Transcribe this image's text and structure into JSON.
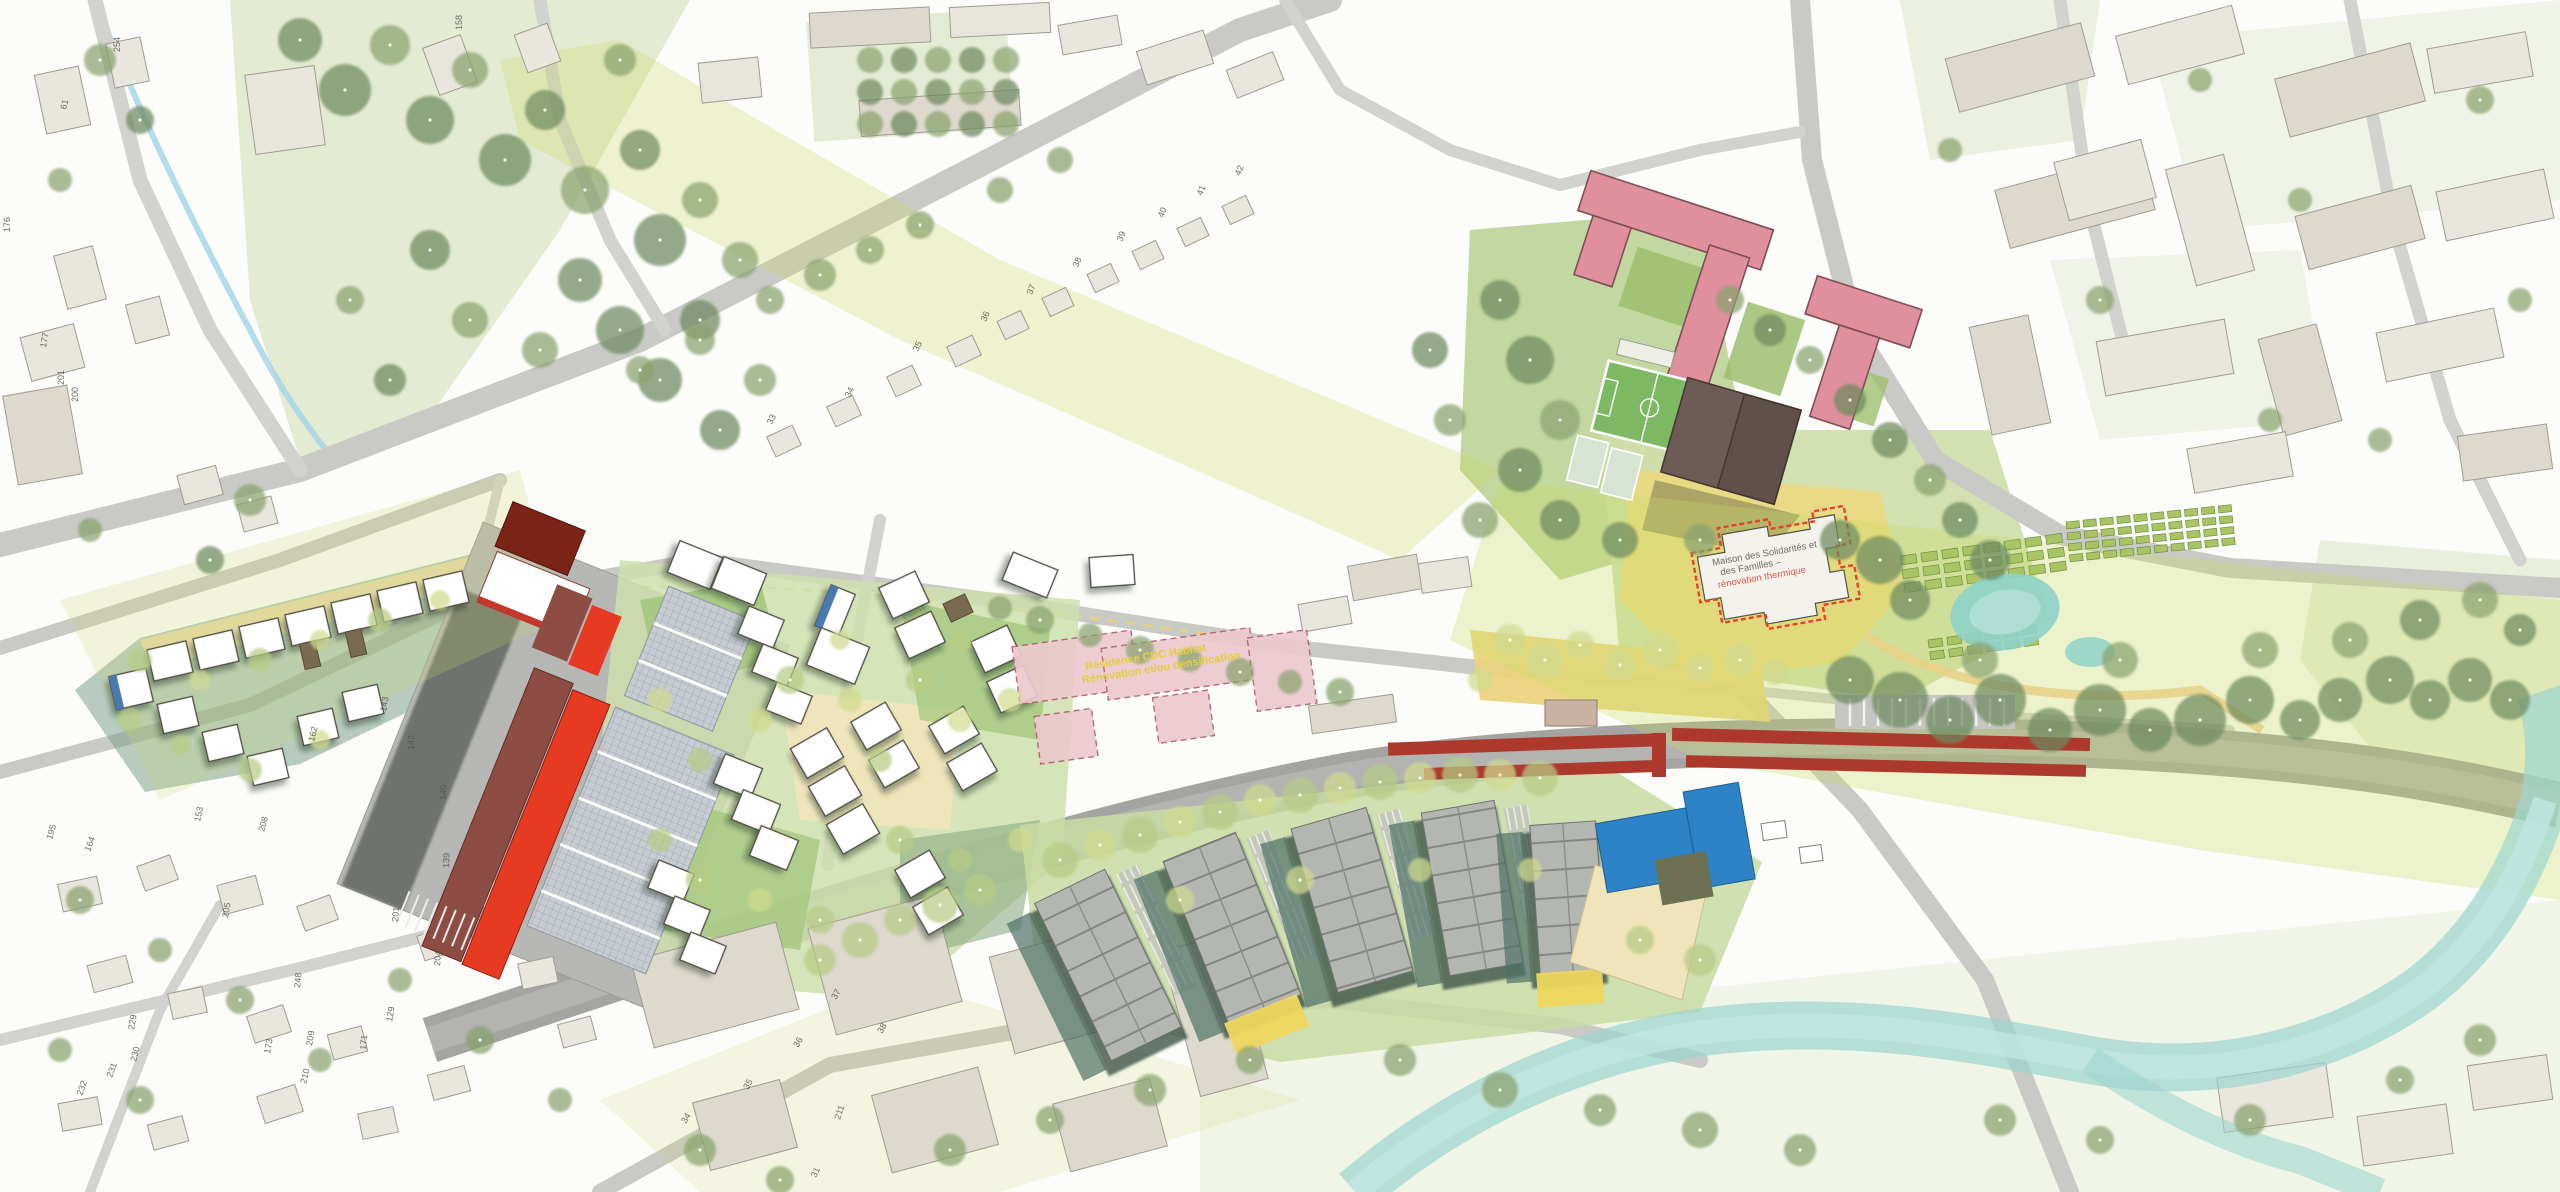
{
  "map": {
    "kind": "urban design masterplan site plan",
    "annotations": {
      "maison": {
        "line1": "Maison des Solidarités et",
        "line2": "des Familles –",
        "line3": "rénovation thermique"
      },
      "residence": {
        "line1": "Résidence CDC Habitat",
        "line2": "Rénovation et/ou densification"
      }
    },
    "colors": {
      "background": "#fcfcfa",
      "road": "#c9c9c6",
      "railway": "#a4a4a2",
      "platform_red": "#ac392c",
      "new_building_red": "#e63a22",
      "new_building_maroon": "#8e4d44",
      "dark_red_hall": "#7c2317",
      "school_pink": "#e08f9d",
      "residence_pink": "#ecc9ce",
      "sports_hall_brown": "#6e5b56",
      "blue_building": "#2d83c6",
      "water_teal": "#9ed6cf",
      "lawn_green": "#9fc478",
      "tree_dark": "#6d8a5e",
      "overlay_yellow_green": "#ccd95e",
      "plaza_yellow": "#ebd47d",
      "annotation_red": "#e4554a",
      "annotation_yellow": "#e3cf3d"
    },
    "parcels": [
      {
        "n": "254",
        "x": 120,
        "y": 52,
        "rot": -90
      },
      {
        "n": "61",
        "x": 66,
        "y": 110,
        "rot": -75
      },
      {
        "n": "176",
        "x": 10,
        "y": 232,
        "rot": -90
      },
      {
        "n": "177",
        "x": 46,
        "y": 348,
        "rot": -80
      },
      {
        "n": "200",
        "x": 78,
        "y": 402,
        "rot": -90
      },
      {
        "n": "201",
        "x": 64,
        "y": 385,
        "rot": -90
      },
      {
        "n": "158",
        "x": 462,
        "y": 30,
        "rot": -90
      },
      {
        "n": "33",
        "x": 772,
        "y": 425,
        "rot": -65
      },
      {
        "n": "34",
        "x": 850,
        "y": 398,
        "rot": -65
      },
      {
        "n": "35",
        "x": 918,
        "y": 352,
        "rot": -65
      },
      {
        "n": "36",
        "x": 986,
        "y": 322,
        "rot": -68
      },
      {
        "n": "37",
        "x": 1032,
        "y": 295,
        "rot": -68
      },
      {
        "n": "38",
        "x": 1078,
        "y": 268,
        "rot": -68
      },
      {
        "n": "39",
        "x": 1122,
        "y": 242,
        "rot": -68
      },
      {
        "n": "40",
        "x": 1163,
        "y": 218,
        "rot": -68
      },
      {
        "n": "41",
        "x": 1202,
        "y": 196,
        "rot": -68
      },
      {
        "n": "42",
        "x": 1240,
        "y": 176,
        "rot": -68
      },
      {
        "n": "142",
        "x": 414,
        "y": 750,
        "rot": -88
      },
      {
        "n": "140",
        "x": 446,
        "y": 800,
        "rot": -88
      },
      {
        "n": "139",
        "x": 449,
        "y": 868,
        "rot": -88
      },
      {
        "n": "143",
        "x": 386,
        "y": 712,
        "rot": -80
      },
      {
        "n": "162",
        "x": 314,
        "y": 742,
        "rot": -76
      },
      {
        "n": "153",
        "x": 200,
        "y": 822,
        "rot": -78
      },
      {
        "n": "164",
        "x": 90,
        "y": 852,
        "rot": -70
      },
      {
        "n": "195",
        "x": 52,
        "y": 840,
        "rot": -74
      },
      {
        "n": "205",
        "x": 228,
        "y": 918,
        "rot": -80
      },
      {
        "n": "208",
        "x": 264,
        "y": 832,
        "rot": -74
      },
      {
        "n": "248",
        "x": 300,
        "y": 988,
        "rot": -84
      },
      {
        "n": "209",
        "x": 312,
        "y": 1046,
        "rot": -80
      },
      {
        "n": "210",
        "x": 306,
        "y": 1084,
        "rot": -76
      },
      {
        "n": "229",
        "x": 134,
        "y": 1030,
        "rot": -80
      },
      {
        "n": "230",
        "x": 136,
        "y": 1062,
        "rot": -75
      },
      {
        "n": "231",
        "x": 112,
        "y": 1078,
        "rot": -70
      },
      {
        "n": "232",
        "x": 82,
        "y": 1096,
        "rot": -70
      },
      {
        "n": "171",
        "x": 366,
        "y": 1050,
        "rot": -85
      },
      {
        "n": "173",
        "x": 270,
        "y": 1054,
        "rot": -80
      },
      {
        "n": "129",
        "x": 392,
        "y": 1022,
        "rot": -80
      },
      {
        "n": "201",
        "x": 398,
        "y": 922,
        "rot": -85
      },
      {
        "n": "204",
        "x": 440,
        "y": 966,
        "rot": -85
      },
      {
        "n": "36",
        "x": 798,
        "y": 1048,
        "rot": -60
      },
      {
        "n": "37",
        "x": 836,
        "y": 1000,
        "rot": -60
      },
      {
        "n": "38",
        "x": 882,
        "y": 1034,
        "rot": -60
      },
      {
        "n": "35",
        "x": 748,
        "y": 1090,
        "rot": -60
      },
      {
        "n": "34",
        "x": 686,
        "y": 1124,
        "rot": -60
      },
      {
        "n": "31",
        "x": 816,
        "y": 1178,
        "rot": -65
      },
      {
        "n": "211",
        "x": 840,
        "y": 1120,
        "rot": -72
      }
    ]
  }
}
